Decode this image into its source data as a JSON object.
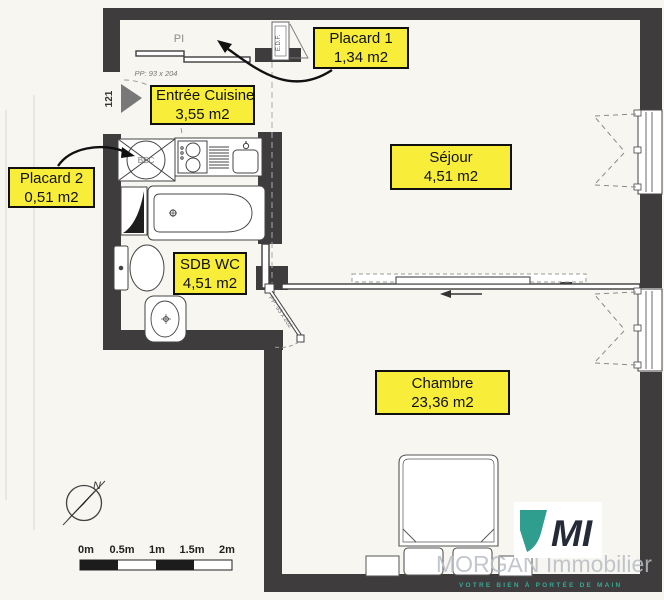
{
  "plan": {
    "rooms": [
      {
        "id": "placard1",
        "name": "Placard 1",
        "area": "1,34 m2"
      },
      {
        "id": "entree_cuisine",
        "name": "Entrée Cuisine",
        "area": "3,55 m2"
      },
      {
        "id": "placard2",
        "name": "Placard 2",
        "area": "0,51 m2"
      },
      {
        "id": "sejour",
        "name": "Séjour",
        "area": "4,51 m2"
      },
      {
        "id": "sdb_wc",
        "name": "SDB WC",
        "area": "4,51 m2"
      },
      {
        "id": "chambre",
        "name": "Chambre",
        "area": "23,36 m2"
      }
    ],
    "annotations": {
      "pi": "PI",
      "door_dim_entry": "PP: 93 x 204",
      "door_dim_sdb": "PP: 93 x 202",
      "door_number": "121",
      "edf": "E.D.F.",
      "bec": "BEC",
      "north": "N"
    }
  },
  "scale_bar": {
    "ticks": [
      "0m",
      "0.5m",
      "1m",
      "1.5m",
      "2m"
    ]
  },
  "branding": {
    "logo_text": "MI",
    "company": "MORGAN Immobilier",
    "tagline": "VOTRE BIEN À PORTÉE DE MAIN"
  },
  "colors": {
    "label_bg": "#f8ee39",
    "wall": "#3f3c3d",
    "teal": "#2f9e8e",
    "navy": "#242a36",
    "paper": "#f7f6f1"
  }
}
